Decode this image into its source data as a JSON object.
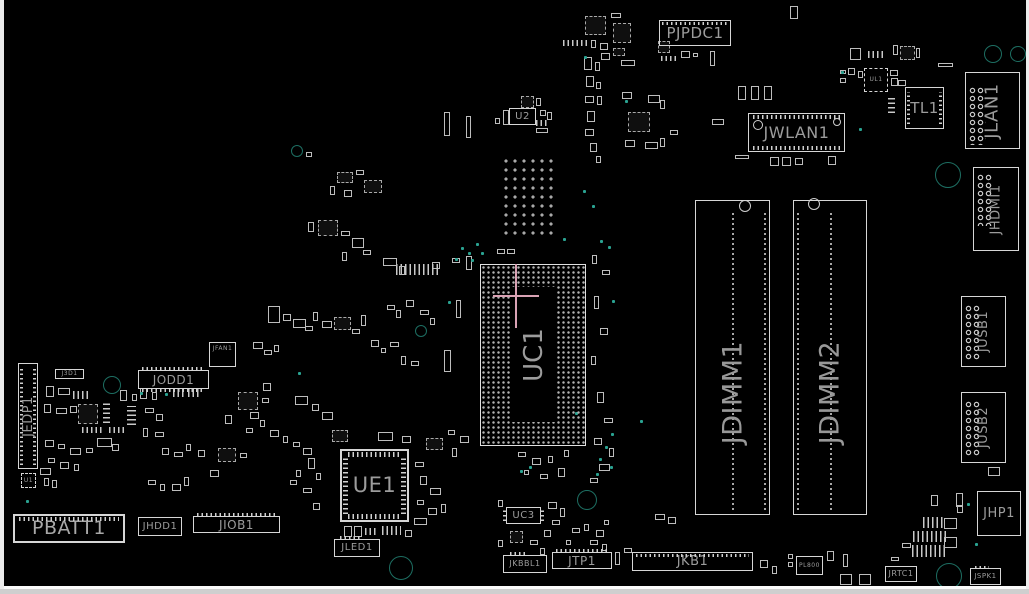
{
  "view": {
    "background": "#000000",
    "silkscreen_color": "#d6d6d6",
    "label_color": "#9c9c9c",
    "teal_ring_color": "#1d6e62",
    "teal_dot_color": "#2aa392",
    "crosshair_color": "#d9a2b4",
    "board_side": "top"
  },
  "components": {
    "pjpdc1": {
      "label": "PJPDC1"
    },
    "jwlan1": {
      "label": "JWLAN1"
    },
    "tl1": {
      "label": "TL1"
    },
    "ul1": {
      "label": "UL1"
    },
    "jlan1": {
      "label": "JLAN1"
    },
    "jhdmi1": {
      "label": "JHDMI1"
    },
    "jusb1": {
      "label": "JUSB1"
    },
    "jusb2": {
      "label": "JUSB2"
    },
    "jdimm1": {
      "label": "JDIMM1"
    },
    "jdimm2": {
      "label": "JDIMM2"
    },
    "uc1": {
      "label": "UC1"
    },
    "ue1": {
      "label": "UE1"
    },
    "u2": {
      "label": "U2"
    },
    "uc3": {
      "label": "UC3"
    },
    "u1": {
      "label": "U1"
    },
    "jedp1": {
      "label": "JEDP1"
    },
    "j3d1": {
      "label": "J3D1"
    },
    "jodd1": {
      "label": "JODD1"
    },
    "jfan1": {
      "label": "JFAN1"
    },
    "pbatt1": {
      "label": "PBATT1"
    },
    "jhdd1": {
      "label": "JHDD1"
    },
    "jiob1": {
      "label": "JIOB1"
    },
    "jled1": {
      "label": "JLED1"
    },
    "jkbbl1": {
      "label": "JKBBL1"
    },
    "jtp1": {
      "label": "JTP1"
    },
    "jkb1": {
      "label": "JKB1"
    },
    "jhp1": {
      "label": "JHP1"
    },
    "jrtc1": {
      "label": "JRTC1"
    },
    "jspk1": {
      "label": "JSPK1"
    },
    "pl800": {
      "label": "PL800"
    }
  },
  "crosshair": {
    "x": 516,
    "y": 296,
    "v_len": 64,
    "h_len": 46
  },
  "holes": [
    [
      757,
      124,
      4
    ],
    [
      836,
      121,
      3
    ],
    [
      744,
      205,
      5
    ],
    [
      813,
      203,
      5
    ]
  ],
  "teal_rings": [
    [
      992,
      53,
      8
    ],
    [
      1017,
      53,
      7
    ],
    [
      947,
      174,
      12
    ],
    [
      111,
      384,
      8
    ],
    [
      400,
      567,
      11
    ],
    [
      586,
      499,
      9
    ],
    [
      948,
      575,
      12
    ],
    [
      296,
      150,
      5
    ],
    [
      420,
      330,
      5
    ]
  ],
  "teal_dots": [
    [
      461,
      247
    ],
    [
      468,
      252
    ],
    [
      476,
      243
    ],
    [
      455,
      258
    ],
    [
      471,
      259
    ],
    [
      481,
      252
    ],
    [
      448,
      301
    ],
    [
      600,
      240
    ],
    [
      608,
      246
    ],
    [
      584,
      56
    ],
    [
      841,
      71
    ],
    [
      26,
      500
    ],
    [
      140,
      392
    ],
    [
      165,
      393
    ],
    [
      611,
      433
    ],
    [
      605,
      446
    ],
    [
      599,
      458
    ],
    [
      610,
      466
    ],
    [
      596,
      473
    ],
    [
      520,
      470
    ],
    [
      529,
      466
    ],
    [
      583,
      190
    ],
    [
      592,
      205
    ],
    [
      563,
      238
    ],
    [
      612,
      300
    ],
    [
      967,
      503
    ],
    [
      975,
      543
    ],
    [
      298,
      372
    ],
    [
      859,
      128
    ],
    [
      625,
      100
    ],
    [
      640,
      420
    ],
    [
      575,
      412
    ]
  ],
  "small_parts": [
    [
      585,
      16,
      21,
      19,
      "c"
    ],
    [
      613,
      23,
      18,
      20,
      "c"
    ],
    [
      611,
      13,
      10,
      5
    ],
    [
      563,
      40,
      27,
      6,
      "h"
    ],
    [
      591,
      40,
      5,
      8
    ],
    [
      600,
      43,
      8,
      7
    ],
    [
      613,
      48,
      12,
      8,
      "c"
    ],
    [
      601,
      53,
      9,
      7
    ],
    [
      621,
      60,
      14,
      6
    ],
    [
      658,
      41,
      12,
      12,
      "c"
    ],
    [
      661,
      56,
      15,
      5,
      "h"
    ],
    [
      681,
      51,
      9,
      7
    ],
    [
      693,
      53,
      5,
      4
    ],
    [
      710,
      51,
      5,
      15
    ],
    [
      790,
      6,
      8,
      13
    ],
    [
      584,
      57,
      8,
      13
    ],
    [
      595,
      62,
      5,
      9
    ],
    [
      586,
      76,
      8,
      11
    ],
    [
      596,
      82,
      5,
      7
    ],
    [
      585,
      96,
      9,
      7
    ],
    [
      597,
      96,
      5,
      9
    ],
    [
      587,
      111,
      8,
      11
    ],
    [
      585,
      129,
      9,
      7
    ],
    [
      590,
      143,
      7,
      9
    ],
    [
      596,
      156,
      5,
      7
    ],
    [
      521,
      96,
      13,
      12,
      "c"
    ],
    [
      536,
      98,
      5,
      8
    ],
    [
      503,
      110,
      6,
      15
    ],
    [
      495,
      118,
      5,
      6
    ],
    [
      540,
      110,
      6,
      6
    ],
    [
      536,
      120,
      12,
      6,
      "h"
    ],
    [
      536,
      128,
      12,
      5
    ],
    [
      547,
      112,
      5,
      8
    ],
    [
      622,
      92,
      10,
      7
    ],
    [
      648,
      95,
      12,
      8
    ],
    [
      660,
      100,
      5,
      9
    ],
    [
      628,
      112,
      22,
      20,
      "c"
    ],
    [
      625,
      140,
      10,
      7
    ],
    [
      645,
      142,
      13,
      7
    ],
    [
      660,
      138,
      5,
      9
    ],
    [
      670,
      130,
      8,
      5
    ],
    [
      738,
      86,
      8,
      14
    ],
    [
      751,
      86,
      8,
      14
    ],
    [
      764,
      86,
      8,
      14
    ],
    [
      712,
      119,
      12,
      6
    ],
    [
      735,
      155,
      14,
      4
    ],
    [
      770,
      157,
      9,
      9
    ],
    [
      782,
      157,
      9,
      9
    ],
    [
      795,
      158,
      8,
      7
    ],
    [
      828,
      156,
      8,
      9
    ],
    [
      850,
      48,
      11,
      12
    ],
    [
      868,
      51,
      18,
      7,
      "h"
    ],
    [
      893,
      45,
      5,
      10
    ],
    [
      900,
      46,
      15,
      14,
      "c"
    ],
    [
      916,
      48,
      4,
      10
    ],
    [
      938,
      63,
      15,
      4
    ],
    [
      840,
      70,
      6,
      4
    ],
    [
      848,
      68,
      7,
      7
    ],
    [
      858,
      71,
      5,
      7
    ],
    [
      840,
      78,
      6,
      5
    ],
    [
      890,
      70,
      8,
      6
    ],
    [
      891,
      78,
      7,
      8
    ],
    [
      898,
      80,
      8,
      6
    ],
    [
      888,
      98,
      7,
      15,
      "v"
    ],
    [
      444,
      112,
      6,
      24
    ],
    [
      466,
      116,
      5,
      22
    ],
    [
      466,
      256,
      6,
      14
    ],
    [
      452,
      258,
      8,
      5
    ],
    [
      432,
      262,
      8,
      7
    ],
    [
      456,
      300,
      5,
      18
    ],
    [
      444,
      350,
      7,
      22
    ],
    [
      396,
      264,
      44,
      11,
      "h"
    ],
    [
      497,
      249,
      8,
      5
    ],
    [
      507,
      249,
      8,
      5
    ],
    [
      306,
      152,
      6,
      5
    ],
    [
      337,
      172,
      16,
      11,
      "c"
    ],
    [
      356,
      170,
      8,
      5
    ],
    [
      364,
      180,
      18,
      13,
      "c"
    ],
    [
      344,
      190,
      8,
      7
    ],
    [
      330,
      186,
      5,
      9
    ],
    [
      308,
      222,
      6,
      10
    ],
    [
      318,
      220,
      20,
      16,
      "c"
    ],
    [
      341,
      231,
      9,
      5
    ],
    [
      352,
      238,
      12,
      10
    ],
    [
      363,
      250,
      8,
      5
    ],
    [
      342,
      252,
      5,
      9
    ],
    [
      383,
      258,
      14,
      8
    ],
    [
      399,
      266,
      6,
      9
    ],
    [
      268,
      306,
      12,
      17
    ],
    [
      283,
      314,
      8,
      7
    ],
    [
      293,
      319,
      13,
      9
    ],
    [
      305,
      326,
      8,
      5
    ],
    [
      313,
      312,
      5,
      9
    ],
    [
      322,
      321,
      10,
      7
    ],
    [
      334,
      317,
      17,
      13,
      "c"
    ],
    [
      352,
      329,
      8,
      5
    ],
    [
      361,
      315,
      5,
      11
    ],
    [
      253,
      342,
      10,
      7
    ],
    [
      264,
      350,
      8,
      5
    ],
    [
      274,
      345,
      5,
      7
    ],
    [
      387,
      305,
      8,
      5
    ],
    [
      396,
      310,
      5,
      8
    ],
    [
      406,
      300,
      8,
      7
    ],
    [
      420,
      310,
      9,
      5
    ],
    [
      430,
      318,
      5,
      7
    ],
    [
      371,
      340,
      8,
      7
    ],
    [
      381,
      348,
      5,
      5
    ],
    [
      390,
      342,
      9,
      5
    ],
    [
      401,
      356,
      5,
      9
    ],
    [
      411,
      361,
      8,
      5
    ],
    [
      46,
      386,
      8,
      11
    ],
    [
      58,
      388,
      12,
      7
    ],
    [
      73,
      391,
      16,
      8,
      "h"
    ],
    [
      44,
      404,
      7,
      9
    ],
    [
      56,
      408,
      11,
      6
    ],
    [
      70,
      406,
      7,
      7
    ],
    [
      78,
      404,
      20,
      20,
      "c"
    ],
    [
      103,
      402,
      7,
      21,
      "v"
    ],
    [
      82,
      427,
      21,
      6,
      "h"
    ],
    [
      109,
      427,
      15,
      6,
      "h"
    ],
    [
      120,
      390,
      7,
      11
    ],
    [
      132,
      394,
      5,
      7
    ],
    [
      127,
      406,
      9,
      19,
      "v"
    ],
    [
      140,
      388,
      7,
      11
    ],
    [
      152,
      392,
      5,
      8
    ],
    [
      145,
      408,
      9,
      5
    ],
    [
      156,
      414,
      7,
      7
    ],
    [
      143,
      428,
      5,
      9
    ],
    [
      155,
      432,
      9,
      5
    ],
    [
      45,
      440,
      9,
      7
    ],
    [
      58,
      444,
      7,
      5
    ],
    [
      70,
      448,
      11,
      7
    ],
    [
      86,
      448,
      7,
      5
    ],
    [
      97,
      438,
      15,
      9
    ],
    [
      112,
      444,
      7,
      7
    ],
    [
      48,
      458,
      7,
      5
    ],
    [
      60,
      462,
      9,
      7
    ],
    [
      40,
      468,
      11,
      7
    ],
    [
      74,
      464,
      5,
      7
    ],
    [
      44,
      478,
      5,
      8
    ],
    [
      52,
      480,
      5,
      8
    ],
    [
      148,
      480,
      8,
      5
    ],
    [
      160,
      484,
      5,
      7
    ],
    [
      172,
      484,
      9,
      7
    ],
    [
      184,
      477,
      5,
      9
    ],
    [
      162,
      448,
      7,
      7
    ],
    [
      174,
      452,
      9,
      5
    ],
    [
      186,
      444,
      5,
      7
    ],
    [
      198,
      450,
      7,
      7
    ],
    [
      218,
      448,
      18,
      14,
      "c"
    ],
    [
      240,
      453,
      7,
      5
    ],
    [
      210,
      470,
      9,
      7
    ],
    [
      238,
      392,
      20,
      18,
      "c"
    ],
    [
      262,
      398,
      7,
      5
    ],
    [
      250,
      412,
      9,
      7
    ],
    [
      225,
      415,
      7,
      9
    ],
    [
      260,
      420,
      5,
      7
    ],
    [
      246,
      428,
      7,
      5
    ],
    [
      270,
      430,
      9,
      7
    ],
    [
      283,
      436,
      5,
      7
    ],
    [
      293,
      442,
      7,
      5
    ],
    [
      303,
      448,
      9,
      7
    ],
    [
      295,
      396,
      13,
      9
    ],
    [
      312,
      404,
      7,
      7
    ],
    [
      322,
      412,
      11,
      8
    ],
    [
      332,
      430,
      16,
      12,
      "c"
    ],
    [
      173,
      388,
      12,
      9,
      "h"
    ],
    [
      188,
      388,
      12,
      9,
      "h"
    ],
    [
      263,
      383,
      8,
      8
    ],
    [
      308,
      458,
      7,
      11
    ],
    [
      316,
      473,
      5,
      7
    ],
    [
      303,
      488,
      9,
      5
    ],
    [
      313,
      503,
      7,
      7
    ],
    [
      296,
      470,
      5,
      7
    ],
    [
      290,
      480,
      7,
      5
    ],
    [
      378,
      432,
      15,
      9
    ],
    [
      402,
      436,
      9,
      7
    ],
    [
      426,
      438,
      17,
      12,
      "c"
    ],
    [
      448,
      430,
      7,
      5
    ],
    [
      460,
      436,
      9,
      7
    ],
    [
      452,
      448,
      5,
      9
    ],
    [
      344,
      526,
      8,
      11
    ],
    [
      354,
      526,
      8,
      11
    ],
    [
      365,
      528,
      13,
      7,
      "h"
    ],
    [
      382,
      526,
      19,
      9,
      "h"
    ],
    [
      405,
      530,
      7,
      7
    ],
    [
      415,
      462,
      9,
      5
    ],
    [
      420,
      476,
      7,
      9
    ],
    [
      430,
      488,
      11,
      7
    ],
    [
      417,
      500,
      7,
      5
    ],
    [
      428,
      508,
      9,
      7
    ],
    [
      441,
      504,
      5,
      9
    ],
    [
      414,
      518,
      13,
      7
    ],
    [
      592,
      255,
      5,
      9
    ],
    [
      602,
      270,
      8,
      5
    ],
    [
      594,
      296,
      5,
      13
    ],
    [
      600,
      328,
      8,
      7
    ],
    [
      591,
      356,
      5,
      9
    ],
    [
      597,
      392,
      7,
      11
    ],
    [
      604,
      418,
      9,
      5
    ],
    [
      594,
      438,
      8,
      7
    ],
    [
      609,
      448,
      5,
      9
    ],
    [
      599,
      464,
      11,
      7
    ],
    [
      590,
      478,
      8,
      5
    ],
    [
      518,
      452,
      8,
      5
    ],
    [
      532,
      458,
      9,
      7
    ],
    [
      548,
      456,
      5,
      7
    ],
    [
      558,
      468,
      7,
      9
    ],
    [
      524,
      470,
      5,
      5
    ],
    [
      540,
      474,
      8,
      5
    ],
    [
      564,
      450,
      5,
      7
    ],
    [
      548,
      502,
      9,
      7
    ],
    [
      560,
      508,
      5,
      9
    ],
    [
      552,
      520,
      8,
      5
    ],
    [
      498,
      500,
      5,
      7
    ],
    [
      510,
      531,
      13,
      12,
      "c"
    ],
    [
      530,
      540,
      8,
      5
    ],
    [
      498,
      540,
      5,
      7
    ],
    [
      544,
      530,
      7,
      7
    ],
    [
      540,
      548,
      5,
      7
    ],
    [
      572,
      528,
      8,
      5
    ],
    [
      584,
      524,
      5,
      7
    ],
    [
      596,
      530,
      8,
      7
    ],
    [
      604,
      520,
      5,
      5
    ],
    [
      566,
      540,
      5,
      5
    ],
    [
      590,
      540,
      8,
      5
    ],
    [
      602,
      544,
      5,
      7
    ],
    [
      615,
      552,
      5,
      13
    ],
    [
      624,
      548,
      8,
      5
    ],
    [
      655,
      514,
      10,
      6
    ],
    [
      668,
      517,
      8,
      7
    ],
    [
      760,
      560,
      8,
      8
    ],
    [
      772,
      566,
      5,
      8
    ],
    [
      788,
      554,
      5,
      5
    ],
    [
      788,
      562,
      5,
      5
    ],
    [
      827,
      551,
      7,
      10
    ],
    [
      843,
      554,
      5,
      13
    ],
    [
      840,
      574,
      12,
      11
    ],
    [
      859,
      574,
      12,
      11
    ],
    [
      891,
      557,
      8,
      4
    ],
    [
      923,
      517,
      20,
      11,
      "h"
    ],
    [
      913,
      531,
      34,
      11,
      "h"
    ],
    [
      912,
      545,
      35,
      12,
      "h"
    ],
    [
      944,
      518,
      13,
      11
    ],
    [
      944,
      537,
      13,
      11
    ],
    [
      931,
      495,
      7,
      11
    ],
    [
      956,
      493,
      7,
      14
    ],
    [
      957,
      505,
      6,
      8
    ],
    [
      902,
      543,
      9,
      5
    ],
    [
      988,
      467,
      12,
      9
    ]
  ]
}
